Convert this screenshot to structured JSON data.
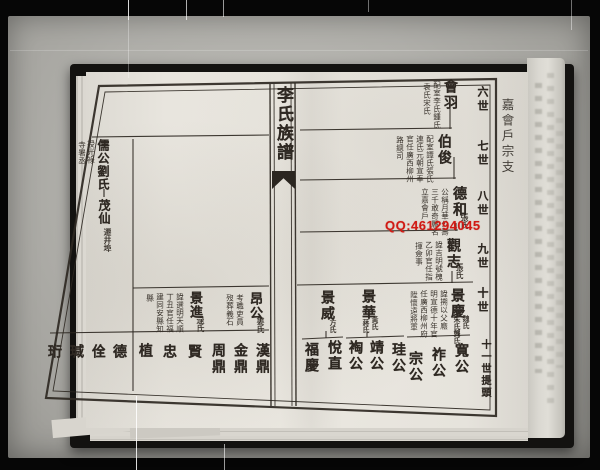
{
  "palette": {
    "ink": "#2e2822",
    "paper": "#e8e5de",
    "photo_gray": "#b0afaa",
    "watermark_red": "#d01a14"
  },
  "watermark": {
    "text": "QQ:461294045",
    "color": "#d01a14"
  },
  "book": {
    "spine_title": "李氏族譜",
    "branch_label": "嘉會戶宗支",
    "generation_labels": [
      "六世",
      "七世",
      "八世",
      "九世",
      "十世",
      "十一世提頭"
    ],
    "right_page": {
      "entries": [
        {
          "name": "會羽",
          "notes": [
            "配室李氏鍾氏",
            "袁氏宋氏"
          ]
        },
        {
          "name": "伯俊",
          "notes": [
            "配室譚氏張氏",
            "連氏元朝宣奉",
            "官任廣西柳州",
            "路總司"
          ]
        },
        {
          "name": "德和",
          "spouse": "張氏",
          "notes": [
            "公稱月華公壽",
            "三千敢奇麗名",
            "立嘉會戶"
          ]
        },
        {
          "name": "觀志",
          "spouse": "張氏",
          "notes": [
            "諱吉明號槐",
            "乙卯官任指",
            "揮僉事"
          ]
        },
        {
          "name": "景慶",
          "spouses": [
            "魏氏",
            "朱氏龔氏"
          ],
          "notes": [
            "諱搠以父廕",
            "明宣德十年官",
            "任廣西柳州府",
            "陞懷遠將軍"
          ]
        },
        {
          "name": "景華",
          "spouses": [
            "黃氏",
            "蔣氏"
          ]
        },
        {
          "name": "景威",
          "spouse": "方氏"
        }
      ],
      "generation11_names": [
        "寬公",
        "祚公",
        "宗公",
        "珪公",
        "靖公",
        "裪公",
        "悅直",
        "福慶"
      ]
    },
    "left_page": {
      "top_entry": {
        "name": "儒公",
        "spouse": "劉氏",
        "notes": [
          "授光祿",
          "寺署丞"
        ],
        "child": {
          "name": "茂仙",
          "note": "遷井埠"
        }
      },
      "bottom_entries": [
        {
          "name": "昂公",
          "spouse": "婁氏",
          "notes": [
            "考職吏員",
            "歿葬義石"
          ]
        },
        {
          "name": "景進",
          "spouse": "逯氏",
          "notes": [
            "諱選明天順",
            "丁丑官任福",
            "建同安縣知",
            "縣"
          ]
        }
      ],
      "bottom_row_names": [
        "漢鼎",
        "金鼎",
        "周鼎",
        "賢",
        "忠",
        "植",
        "德",
        "佺",
        "瑊",
        "珩"
      ]
    }
  }
}
